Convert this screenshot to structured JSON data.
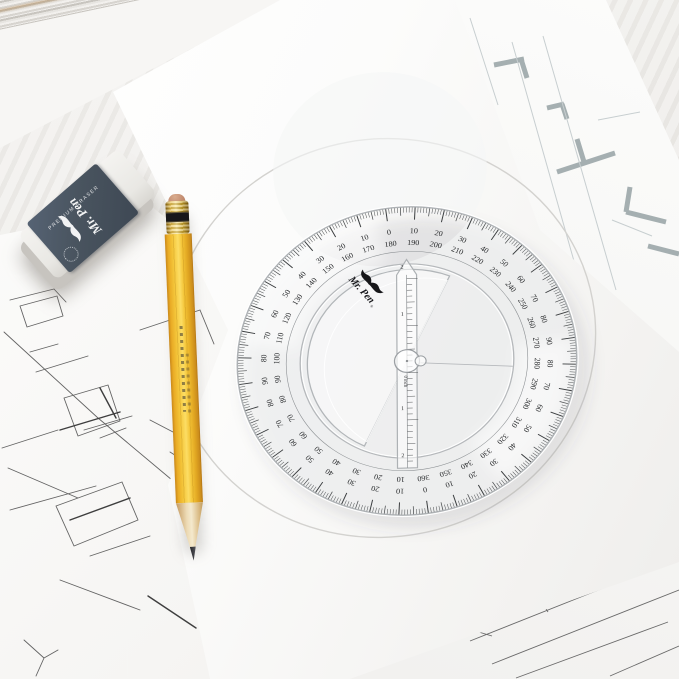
{
  "eraser": {
    "brand": "Mr. Pen",
    "label": "PREMIUM ERASER"
  },
  "protractor": {
    "brand": "Mr. Pen",
    "registered_mark": "®",
    "zero_inch_label": "0 inch",
    "inch_labels": [
      "1",
      "2"
    ],
    "degree_pairs_cw_from_top": [
      [
        "0",
        "180"
      ],
      [
        "10",
        "190"
      ],
      [
        "20",
        "200"
      ],
      [
        "30",
        "210"
      ],
      [
        "40",
        "220"
      ],
      [
        "50",
        "230"
      ],
      [
        "60",
        "240"
      ],
      [
        "70",
        "250"
      ],
      [
        "80",
        "260"
      ],
      [
        "90",
        "270"
      ],
      [
        "80",
        "280"
      ],
      [
        "70",
        "290"
      ],
      [
        "60",
        "300"
      ],
      [
        "50",
        "310"
      ],
      [
        "40",
        "320"
      ],
      [
        "30",
        "330"
      ],
      [
        "20",
        "340"
      ],
      [
        "10",
        "350"
      ],
      [
        "0",
        "360"
      ],
      [
        "10",
        "10"
      ],
      [
        "20",
        "20"
      ],
      [
        "30",
        "30"
      ],
      [
        "40",
        "40"
      ],
      [
        "50",
        "50"
      ],
      [
        "60",
        "60"
      ],
      [
        "70",
        "70"
      ],
      [
        "80",
        "80"
      ],
      [
        "90",
        "90"
      ],
      [
        "80",
        "100"
      ],
      [
        "70",
        "110"
      ],
      [
        "60",
        "120"
      ],
      [
        "50",
        "130"
      ],
      [
        "40",
        "140"
      ],
      [
        "30",
        "150"
      ],
      [
        "20",
        "160"
      ],
      [
        "10",
        "170"
      ]
    ]
  }
}
